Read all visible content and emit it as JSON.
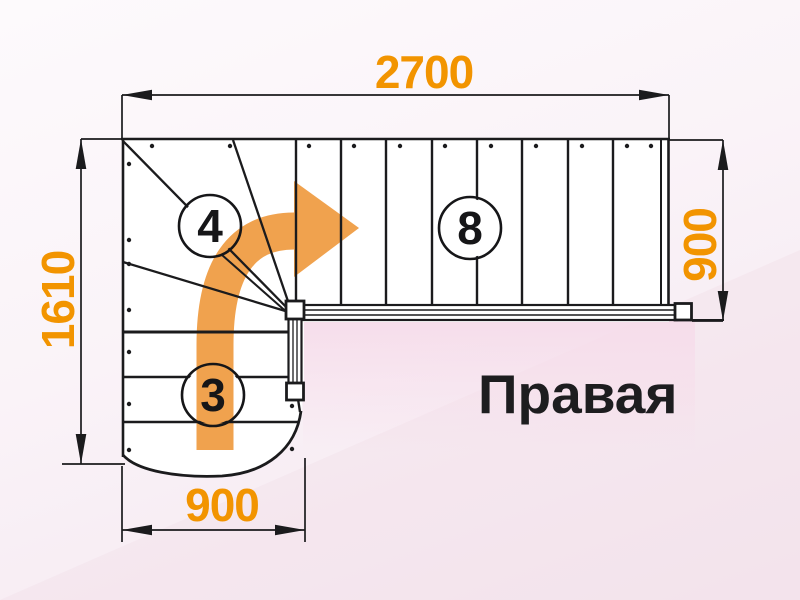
{
  "diagram": {
    "orientation_label": "Правая",
    "dimensions": {
      "top_width": "2700",
      "left_height": "1610",
      "right_flight_width": "900",
      "bottom_flight_width": "900"
    },
    "step_counts": {
      "winder_steps": "4",
      "upper_flight_steps": "8",
      "lower_flight_steps": "3"
    },
    "colors": {
      "dimension_text": "#F29400",
      "direction_arrow": "#F0A24E",
      "line": "#1B1B1D",
      "floor_shading": "#F8E2EE"
    }
  }
}
